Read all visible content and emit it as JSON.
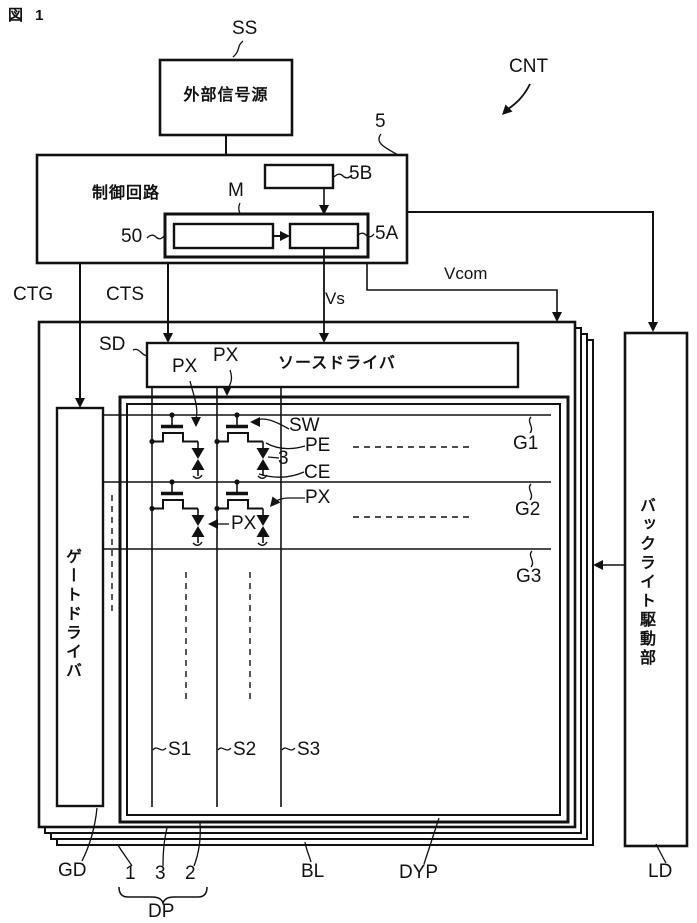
{
  "figure_label": "図 1",
  "blocks": {
    "external_signal_source": {
      "label": "外部信号源",
      "ref": "SS"
    },
    "control_circuit": {
      "label": "制御回路",
      "ref": "5",
      "register_ref": "5B",
      "memory_box_ref": "50",
      "memory_ref": "M",
      "output_ref": "5A"
    },
    "source_driver": {
      "label": "ソースドライバ",
      "ref": "SD"
    },
    "gate_driver": {
      "label": "ゲートドライバ",
      "ref": "GD"
    },
    "backlight_driver": {
      "label": "バックライト駆動部",
      "ref": "LD"
    }
  },
  "signals": {
    "cnt": "CNT",
    "ctg": "CTG",
    "cts": "CTS",
    "vs": "Vs",
    "vcom": "Vcom"
  },
  "pixel_labels": {
    "px": "PX",
    "sw": "SW",
    "pe": "PE",
    "lc": "3",
    "ce": "CE"
  },
  "gate_lines": [
    "G1",
    "G2",
    "G3"
  ],
  "source_lines": [
    "S1",
    "S2",
    "S3"
  ],
  "panel": {
    "display": "DYP",
    "backlight": "BL",
    "layers": [
      "1",
      "3",
      "2"
    ],
    "layer_group": "DP"
  }
}
